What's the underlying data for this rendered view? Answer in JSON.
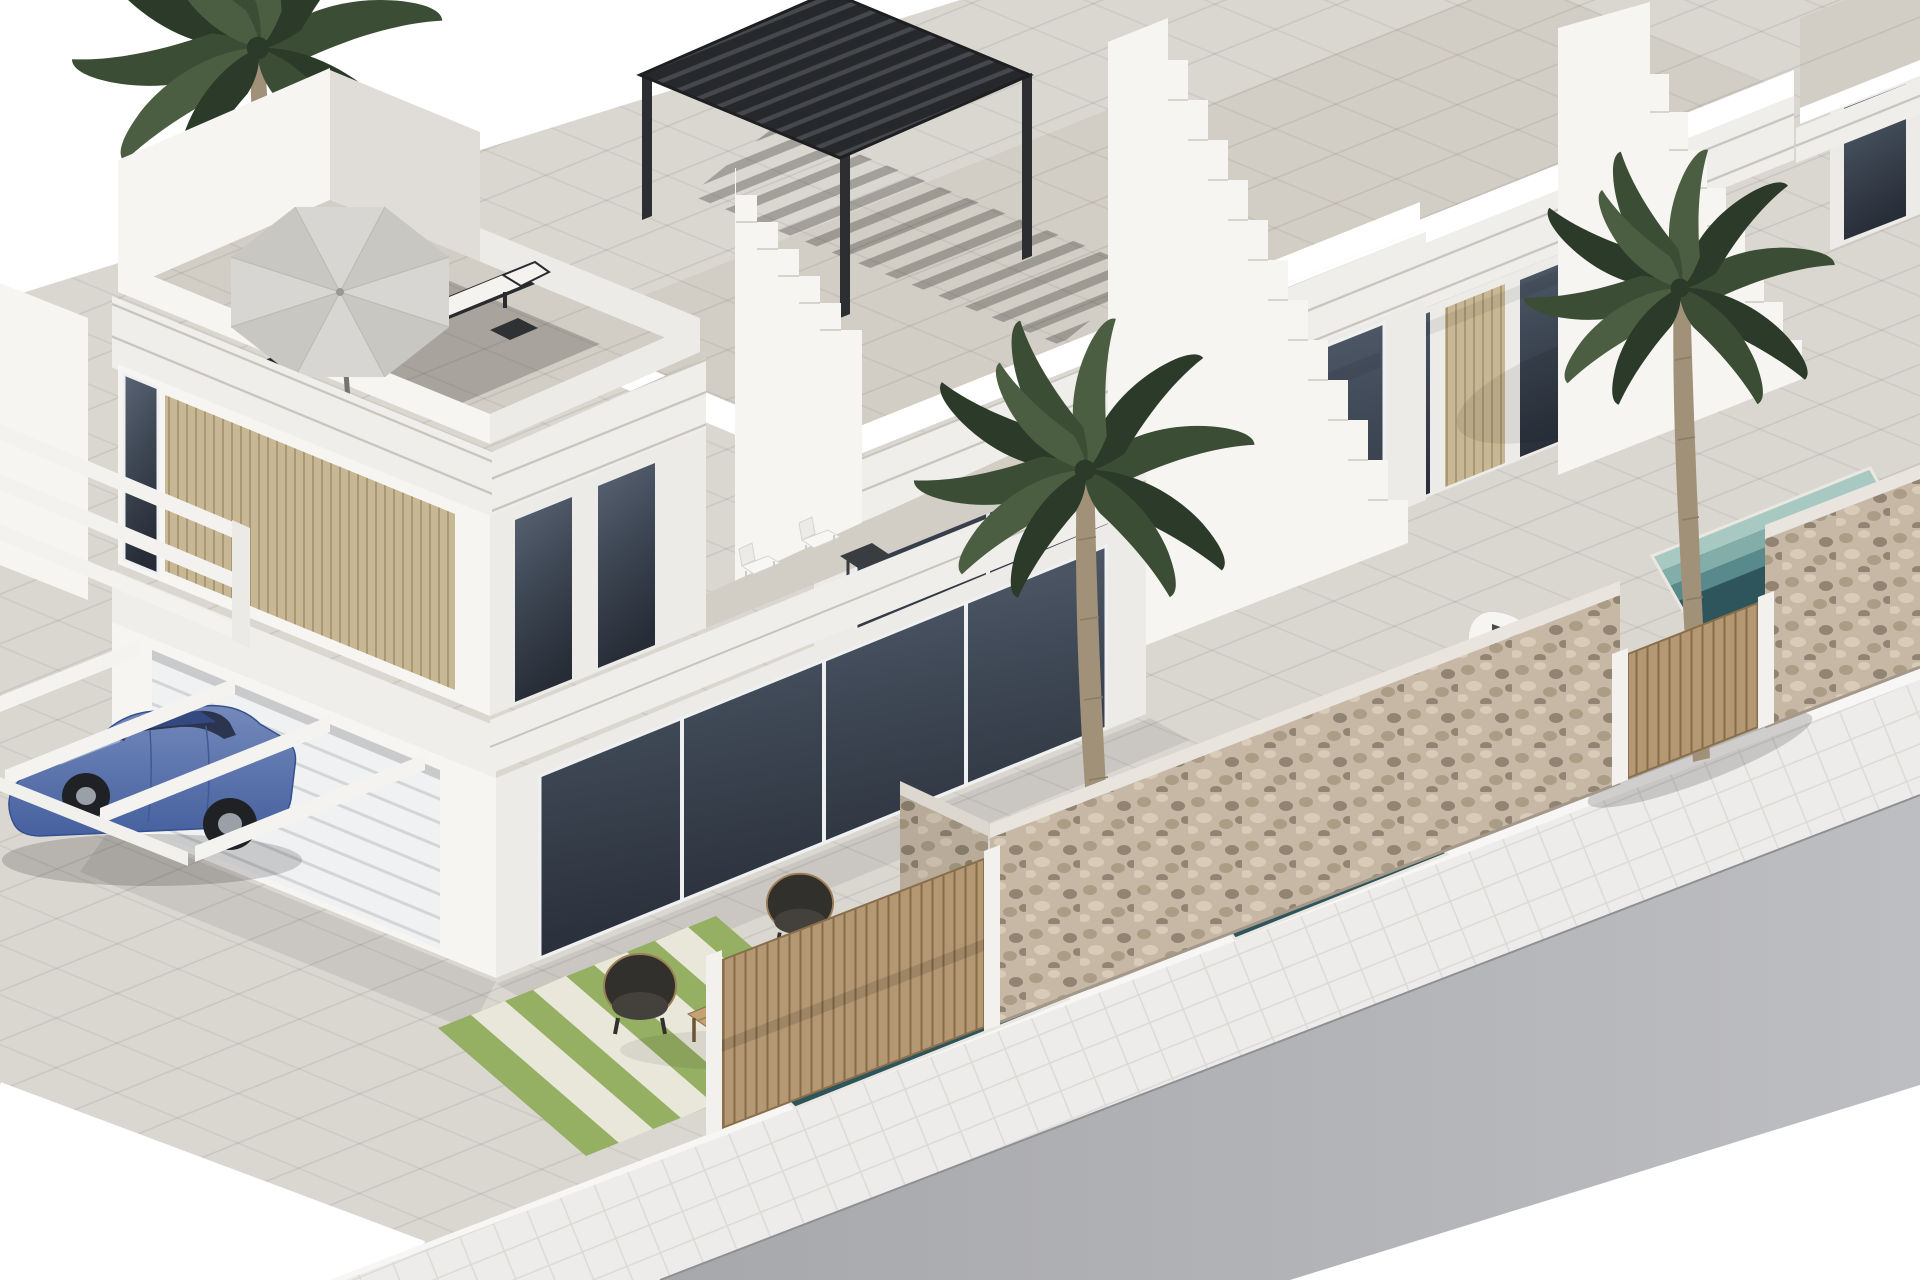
{
  "meta": {
    "title": "Modern white villas — 3D architectural render",
    "canvas": {
      "width": 1920,
      "height": 1280
    }
  },
  "scene": {
    "description": "Isometric 3D architectural rendering of a row of modern white Mediterranean townhouses with rooftop terraces, a gray parasol with two sun loungers, a black louvered pergola, exterior white staircases, palm trees, plunge pools with mosaic steps, natural stone garden walls with wooden slatted gates, a blue sedan parked under a white carport, a grass driveway with paver strips, and a sidewalk with an asphalt road in the foreground.",
    "objects": [
      "white sky background",
      "foreground two-storey villa with rooftop terrace",
      "gray octagonal parasol",
      "two dark sun loungers with white cushions",
      "black louvered rooftop pergola",
      "white exterior staircases between units",
      "beige slatted privacy panels",
      "dark tinted floor-to-ceiling glazing",
      "white garage door",
      "white carport beams",
      "blue sedan",
      "balcony set with white chairs and dark table",
      "rattan lounge chairs and wooden coffee table",
      "three palm trees",
      "plunge pools with teal tiled steps",
      "natural stone garden walls",
      "wooden slatted gates",
      "white water feature",
      "grass driveway with pale paver strips",
      "white sidewalk",
      "gray asphalt road"
    ]
  },
  "palette": {
    "sky": "#ffffff",
    "white": "#ffffff",
    "wallLit": "#f6f5f2",
    "wallMid": "#edebe7",
    "wallShade": "#e0ddd8",
    "fasciaLit": "#f0eeea",
    "fasciaLine": "#c7c4be",
    "floorTile": "#d8d3cc",
    "roofFloor": "#d2cdc5",
    "glassLight": "#5a6575",
    "glassMid": "#3d4653",
    "glassDark": "#272d37",
    "frameWhite": "#eef0f1",
    "beige": "#c8b794",
    "beigeLine": "#a3906a",
    "pergola": "#26282b",
    "pergolaSlat": "#45484d",
    "umbrella": "#d8d6d2",
    "umbrellaShade": "#c9c7c2",
    "loungeDark": "#2a2b2e",
    "cushion": "#f4f3ef",
    "woodTable": "#c3a273",
    "woodTableLine": "#a08050",
    "wicker": "#32302c",
    "wickerRim": "#9c7f55",
    "grass": "#95af63",
    "grassPale": "#e9e6da",
    "poolDeep": "#2e555b",
    "poolStep1": "#58898b",
    "poolStep2": "#83ada8",
    "poolStep3": "#a8c9c1",
    "poolRim": "#24454a",
    "stone": "#c6b8a5",
    "stonePebble1": "#ab9c86",
    "stonePebble2": "#d8ccb9",
    "stonePebble3": "#918472",
    "wood": "#b49873",
    "woodLine": "#876c49",
    "road": "#a7a8ac",
    "roadLight": "#bdbec2",
    "sidewalk": "#edecea",
    "sidewalkLine": "#dbdad6",
    "pavement": "#dad6d0",
    "curb": "#f7f6f4",
    "carBodyLight": "#7489bb",
    "carBodyDark": "#46619f",
    "carRoof": "#33497f",
    "carGlass": "#2b3550",
    "carWheel": "#1f2125",
    "carHub": "#9aa0a8",
    "palmDark": "#2c3a29",
    "palmMid": "#3b4d34",
    "palmLight": "#4c5e41",
    "trunk": "#a09178",
    "trunkLine": "#8a7c66",
    "gridLine": "rgba(0,0,0,0.08)",
    "gridLine2": "rgba(0,0,0,0.06)",
    "shadow": "rgba(0,0,0,0.16)",
    "shadowSoft": "rgba(0,0,0,0.07)",
    "shadowStrong": "rgba(0,0,0,0.2)"
  }
}
